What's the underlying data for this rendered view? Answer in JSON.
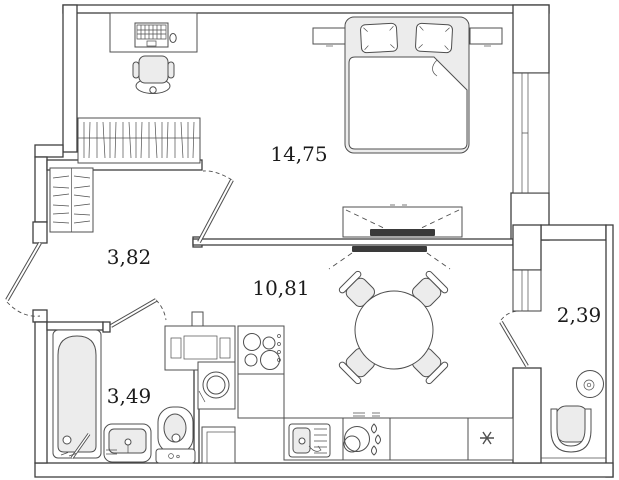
{
  "plan": {
    "title": "apartment-floor-plan",
    "rooms": [
      {
        "name": "bedroom",
        "area_label": "14,75"
      },
      {
        "name": "hallway",
        "area_label": "3,82"
      },
      {
        "name": "kitchen-living-room",
        "area_label": "10,81"
      },
      {
        "name": "bathroom",
        "area_label": "3,49"
      },
      {
        "name": "balcony",
        "area_label": "2,39"
      }
    ],
    "colors": {
      "wall_line": "#3f3f3f",
      "furniture_line": "#4f4f4f",
      "light_fill": "#ececec",
      "tv_fill": "#3a3a3a",
      "label_text": "#1b1b1b",
      "background": "#ffffff"
    }
  }
}
